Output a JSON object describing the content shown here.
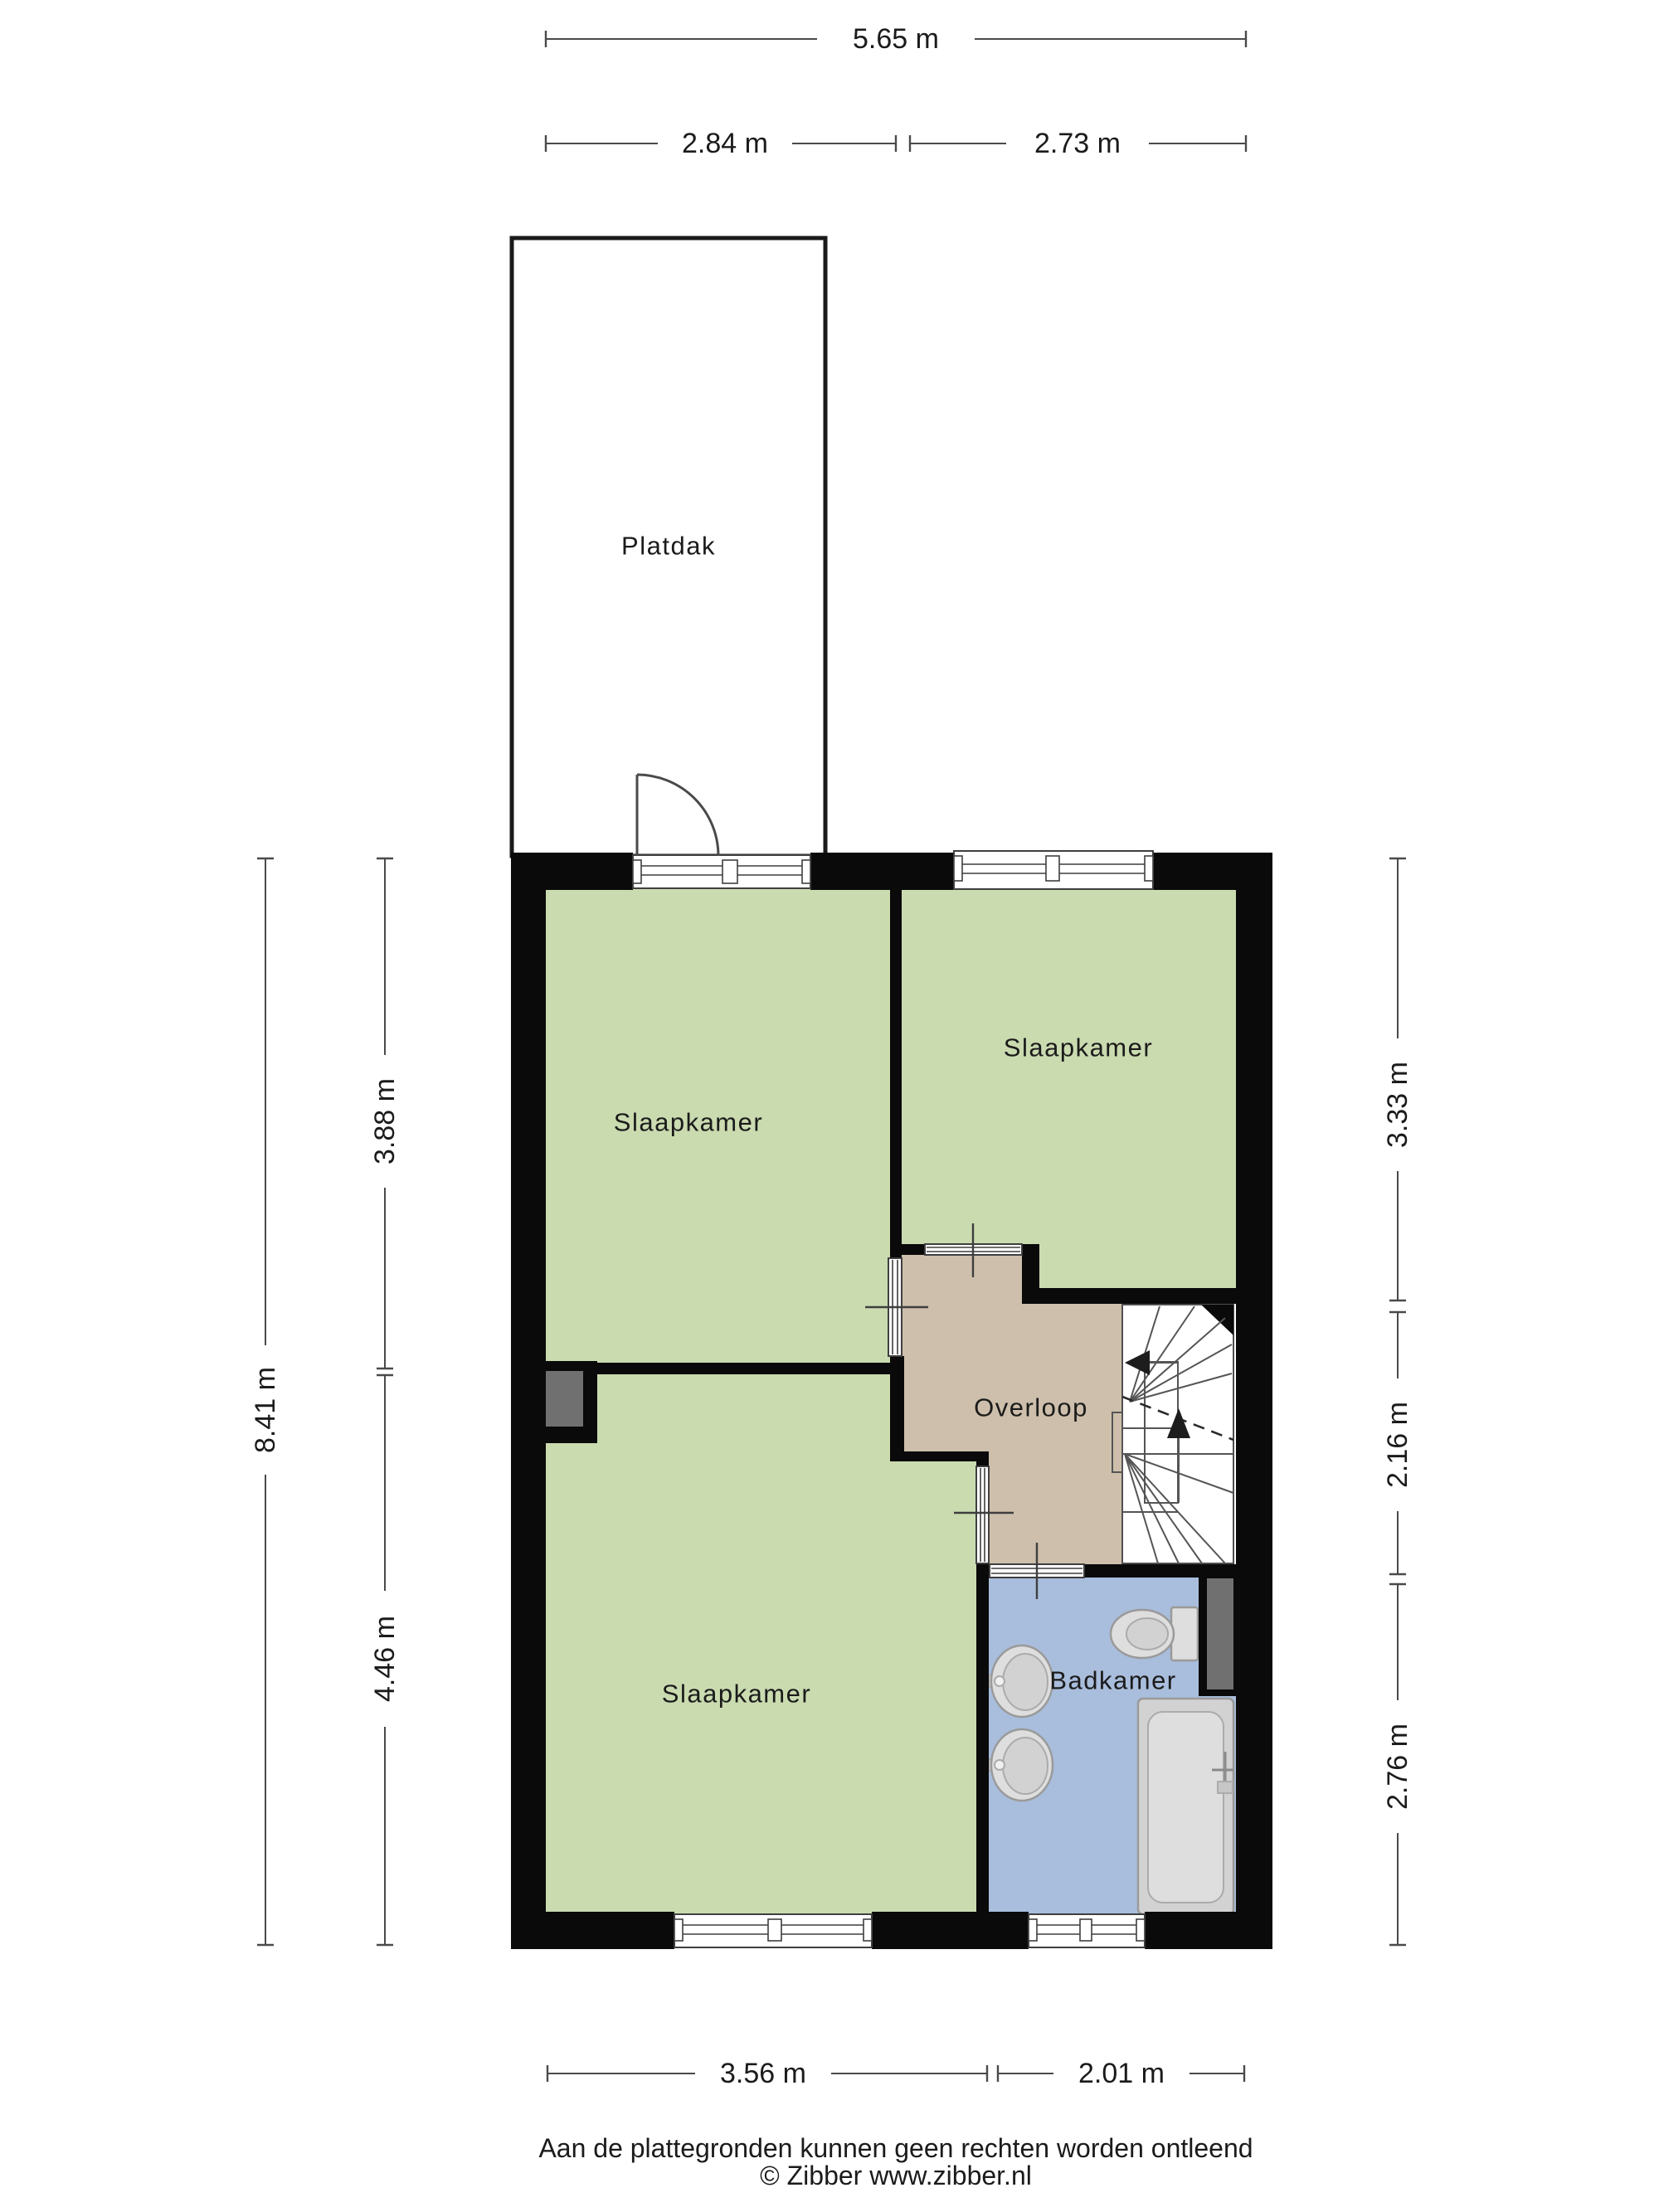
{
  "rooms": {
    "platdak": "Platdak",
    "bedroom_top_left": "Slaapkamer",
    "bedroom_top_right": "Slaapkamer",
    "bedroom_bottom": "Slaapkamer",
    "landing": "Overloop",
    "bathroom": "Badkamer"
  },
  "dimensions": {
    "total_width": "5.65 m",
    "top_left_width": "2.84 m",
    "top_right_width": "2.73 m",
    "total_height": "8.41 m",
    "left_upper": "3.88 m",
    "left_lower": "4.46 m",
    "right_upper": "3.33 m",
    "right_middle": "2.16 m",
    "right_lower": "2.76 m",
    "bottom_left_width": "3.56 m",
    "bottom_right_width": "2.01 m"
  },
  "footer": {
    "disclaimer": "Aan de plattegronden kunnen geen rechten worden ontleend",
    "copyright": "© Zibber www.zibber.nl"
  },
  "colors": {
    "room_green": "#cadbb0",
    "landing_tan": "#cdbfab",
    "bathroom_blue": "#a9bddc",
    "wall_black": "#0a0a0a",
    "shaft_gray": "#707070",
    "fixture_gray": "#dedede",
    "fixture_gray_dark": "#d2d2d2"
  }
}
